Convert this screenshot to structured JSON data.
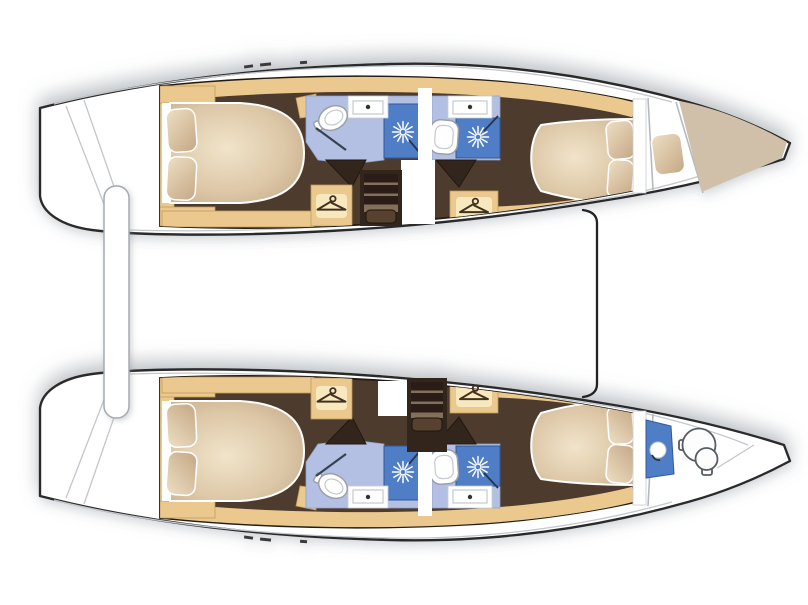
{
  "diagram": {
    "label": "Catamaran sailing yacht interior deck plan, bows to the right: two parallel hulls each with an aft double cabin, shower room with toilet and washbasin, companionway stairs, wardrobes, a forward double cabin and a forepeak; top hull forepeak has a crew berth cushion and tan bow locker, bottom hull forepeak has a washbasin unit and marine toilet; hulls joined by an aft crossbeam and a forward beam",
    "type": "boat-floorplan",
    "bow_direction": "right",
    "hulls": [
      {
        "id": "top-hull",
        "rooms": [
          {
            "name": "transom-steps",
            "fixtures": [
              "swim-steps"
            ]
          },
          {
            "name": "aft-cabin",
            "fixtures": [
              "double-berth",
              "pillow",
              "pillow",
              "side-shelves"
            ]
          },
          {
            "name": "aft-bathroom",
            "fixtures": [
              "toilet",
              "washbasin",
              "shower"
            ]
          },
          {
            "name": "companionway",
            "fixtures": [
              "stairs",
              "landing"
            ]
          },
          {
            "name": "wardrobe-aft",
            "icon": "hanger-icon"
          },
          {
            "name": "forward-bathroom",
            "fixtures": [
              "toilet",
              "washbasin",
              "shower"
            ]
          },
          {
            "name": "wardrobe-forward",
            "icon": "hanger-icon"
          },
          {
            "name": "forward-cabin",
            "fixtures": [
              "double-berth",
              "pillow",
              "pillow"
            ]
          },
          {
            "name": "forepeak",
            "fixtures": [
              "crew-berth-cushion"
            ]
          },
          {
            "name": "bow-locker",
            "fixtures": []
          }
        ]
      },
      {
        "id": "bottom-hull",
        "rooms": [
          {
            "name": "transom-steps",
            "fixtures": [
              "swim-steps"
            ]
          },
          {
            "name": "aft-cabin",
            "fixtures": [
              "double-berth",
              "pillow",
              "pillow",
              "side-shelves"
            ]
          },
          {
            "name": "aft-bathroom",
            "fixtures": [
              "toilet",
              "washbasin",
              "shower"
            ]
          },
          {
            "name": "companionway",
            "fixtures": [
              "stairs",
              "landing"
            ]
          },
          {
            "name": "wardrobe-aft",
            "icon": "hanger-icon"
          },
          {
            "name": "forward-bathroom",
            "fixtures": [
              "toilet",
              "washbasin",
              "shower"
            ]
          },
          {
            "name": "wardrobe-forward",
            "icon": "hanger-icon"
          },
          {
            "name": "forward-cabin",
            "fixtures": [
              "double-berth",
              "pillow",
              "pillow"
            ]
          },
          {
            "name": "forepeak",
            "fixtures": [
              "washbasin-unit",
              "marine-toilet",
              "grab-rail"
            ]
          },
          {
            "name": "bow",
            "fixtures": []
          }
        ]
      }
    ],
    "cross_structures": [
      "aft-crossbeam",
      "forward-beam"
    ]
  },
  "icons": {
    "shower": "starburst-rose-icon",
    "wardrobe": "clothes-hanger-icon",
    "toilet": "top-view-wc-icon",
    "washbasin": "counter-with-tap-icon"
  },
  "colors": {
    "outline": "#2a2a2a",
    "hull_white": "#ffffff",
    "deck_gray": "#c3c7cc",
    "floor_brown": "#4e3a2d",
    "floor_dark": "#33261d",
    "joinery_beige": "#ebc98e",
    "joinery_edge": "#c09a58",
    "joinery_light": "#f8e8c0",
    "bathroom_blue": "#b3c0e3",
    "shower_blue": "#4f7ec6",
    "bed_light": "#f1e4ca",
    "bed_dark": "#c2a787",
    "pillow_light": "#eedfc4",
    "pillow_dark": "#c9ae8c",
    "bow_tan": "#d1c0a9",
    "hanger_brown": "#42301f",
    "shadow_gray": "#8f959c"
  }
}
